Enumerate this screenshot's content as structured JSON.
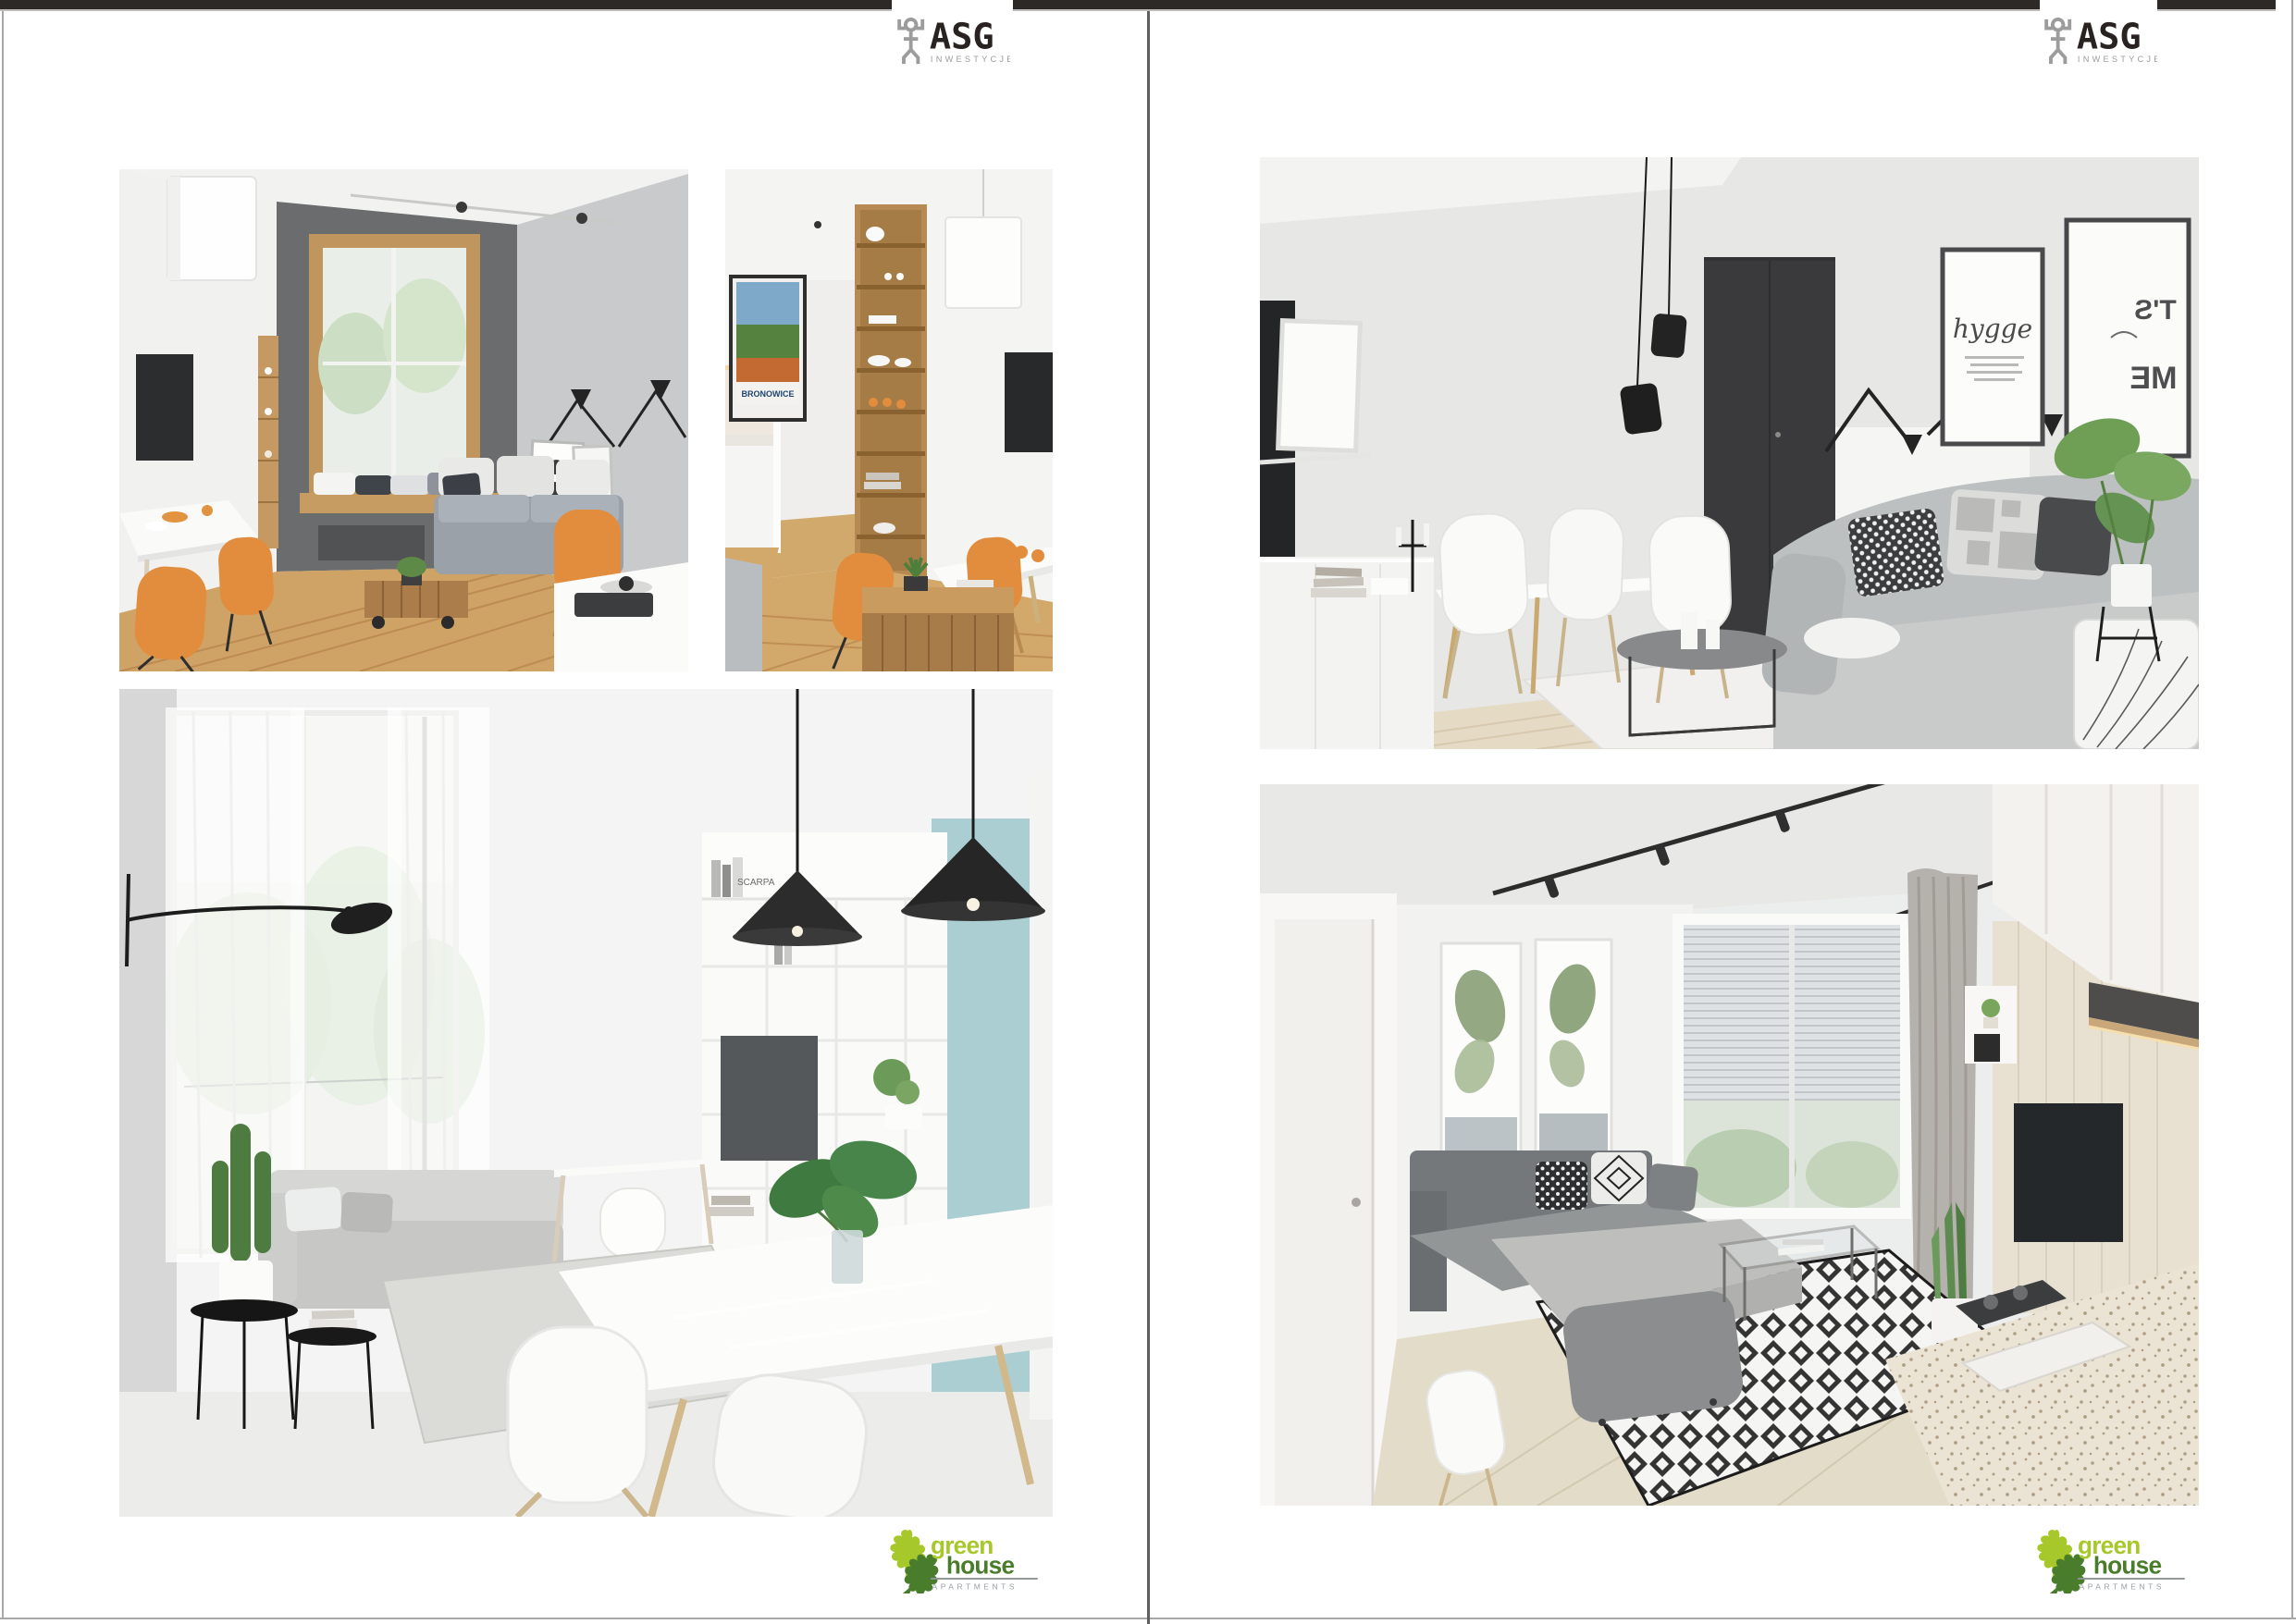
{
  "brand": {
    "asg": {
      "name": "ASG",
      "subtitle": "INWESTYCJE"
    },
    "greenhouse": {
      "word1": "green",
      "word2": "house",
      "subtitle": "APARTMENTS"
    }
  },
  "photo_texts": {
    "bronowice_poster": "BRONOWICE",
    "hygge_poster": "hygge",
    "mirror_poster_line1": "T'S",
    "mirror_poster_line2": "ME",
    "book_spine": "SCARPA"
  },
  "colors": {
    "top_bar": "#2d2926",
    "bar_underline": "#bdbdbd",
    "page_border": "#a8a8a8",
    "center_divider": "#5f5f5f",
    "asg_dark": "#282321",
    "asg_gray": "#9c9c9c",
    "green_light": "#a6c82a",
    "green_dark": "#4a7d2b",
    "label_gray": "#99a0a4",
    "orange": "#e28d3e",
    "teal": "#abced3",
    "wood": "#cda268"
  }
}
